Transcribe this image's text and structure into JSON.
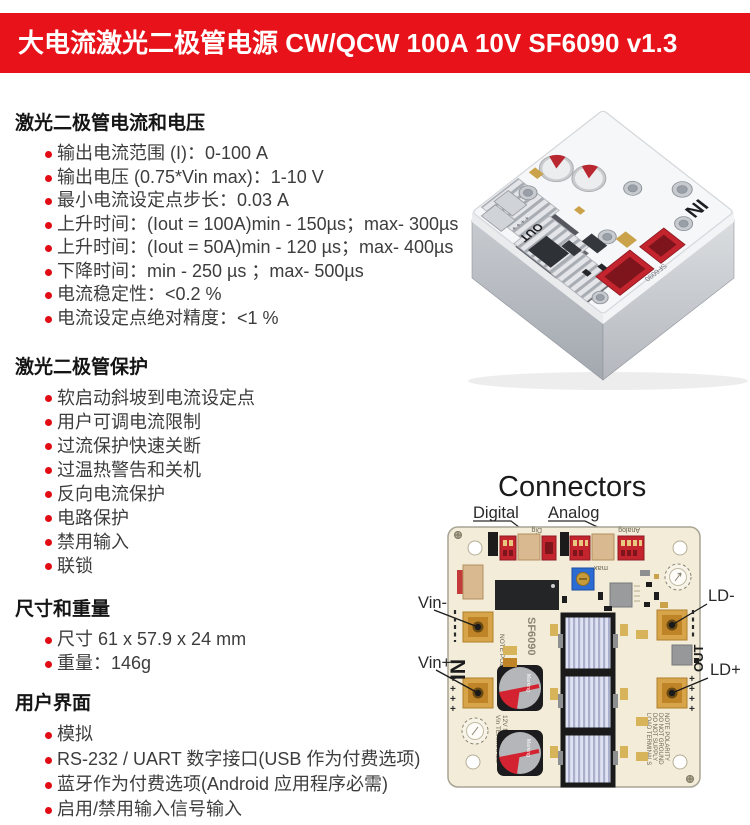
{
  "header": {
    "title": "大电流激光二极管电源 CW/QCW 100A 10V SF6090 v1.3",
    "bg_color": "#e8131a"
  },
  "sections": [
    {
      "title": "激光二极管电流和电压",
      "items": [
        "输出电流范围 (I)：0-100 A",
        "输出电压 (0.75*Vin max)：1-10 V",
        "最小电流设定点步长：0.03 A",
        "上升时间：(Iout = 100A)min - 150µs；max- 300µs",
        "上升时间：(Iout = 50A)min - 120 µs；max- 400µs",
        "下降时间：min - 250 µs ；max- 500µs",
        "电流稳定性：<0.2 %",
        "电流设定点绝对精度：<1 %"
      ]
    },
    {
      "title": "激光二极管保护",
      "items": [
        "软启动斜坡到电流设定点",
        "用户可调电流限制",
        "过流保护快速关断",
        "过温热警告和关机",
        "反向电流保护",
        "电路保护",
        "禁用输入",
        "联锁"
      ]
    },
    {
      "title": "尺寸和重量",
      "items": [
        "尺寸 61 x 57.9 x 24 mm",
        "重量：146g"
      ]
    },
    {
      "title": "用户界面",
      "items": [
        "模拟",
        "RS-232 / UART 数字接口(USB 作为付费选项)",
        "蓝牙作为付费选项(Android 应用程序必需)",
        "启用/禁用输入信号输入"
      ]
    }
  ],
  "photo": {
    "in_label": "IN",
    "out_label": "OUT",
    "model": "SF6090",
    "plus_marks": "+ + + +"
  },
  "connectors": {
    "title": "Connectors",
    "labels": {
      "digital": "Digital",
      "analog": "Analog",
      "vin_minus": "Vin-",
      "vin_plus": "Vin+",
      "ld_minus": "LD-",
      "ld_plus": "LD+"
    },
    "board_texts": {
      "in": "IN",
      "out": "OUT",
      "model": "SF6090",
      "serial": "0690",
      "note_polarity": "NOTE POLARITY",
      "dig": "Dig",
      "analog_silk": "Analog",
      "max": "max",
      "cap_marking": "Marking",
      "plus_marks": "+ + + +",
      "vin_terminals": [
        "Vin TERMINALS",
        "12V NOMINAL"
      ],
      "load_terminals": [
        "LOAD TERMINALS",
        "DO NOT SUPPLY",
        "DO NOT GROUND",
        "NOTE POLARITY"
      ]
    },
    "colors": {
      "board": "#f2ecd9",
      "pad": "#d8a44a",
      "connector_red": "#c4242e",
      "silk": "#6b6450"
    }
  }
}
